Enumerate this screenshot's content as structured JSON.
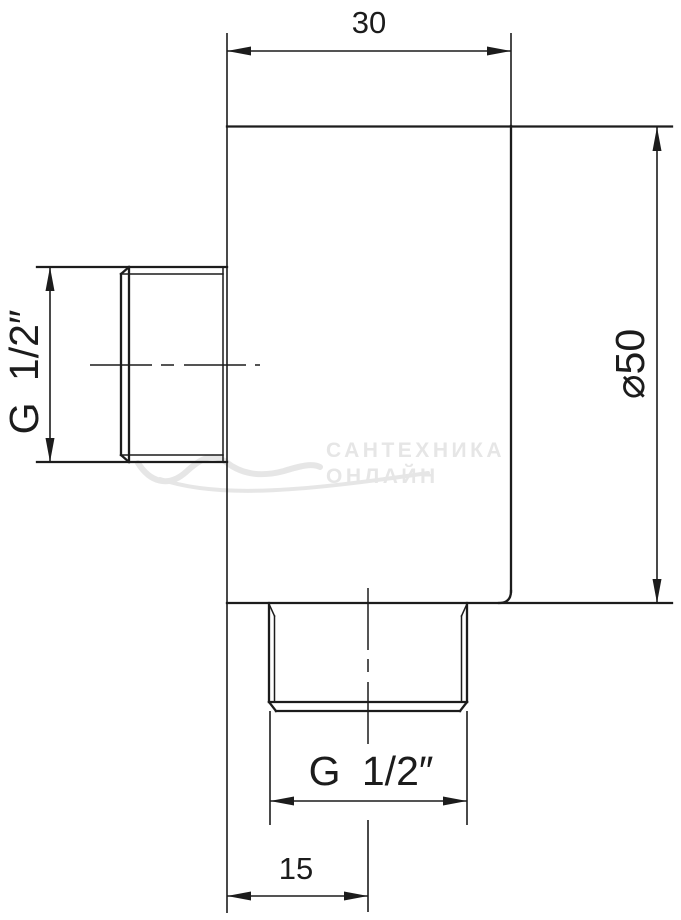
{
  "colors": {
    "line": "#1c1c1c",
    "background": "#ffffff",
    "watermark": "#e6e6e6"
  },
  "drawing": {
    "dimensions": {
      "width_top": "30",
      "diameter_right": "⌀50",
      "thread_left": "G 1/2″",
      "thread_bottom": "G 1/2″",
      "offset_bottom": "15"
    },
    "watermark": {
      "line1": "САНТЕХНИКА",
      "line2": "ОНЛАЙН"
    }
  }
}
